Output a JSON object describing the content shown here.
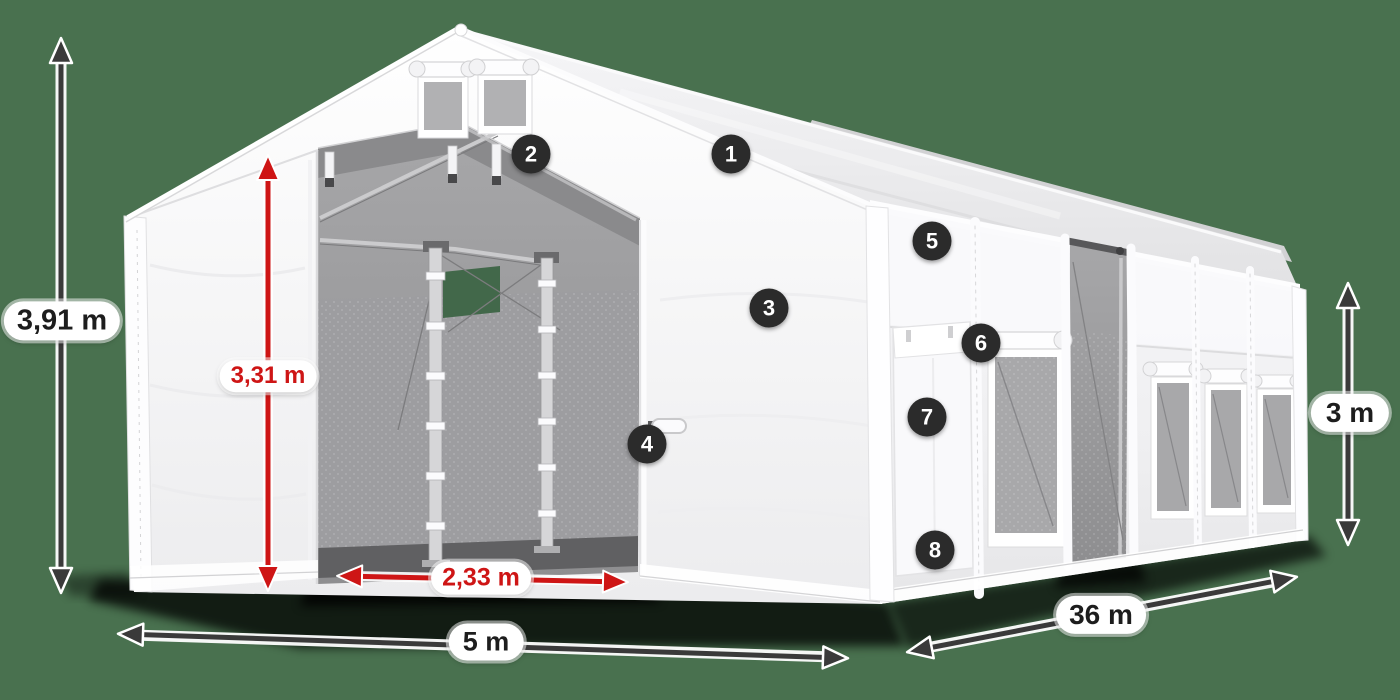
{
  "background_color": "#49714F",
  "colors": {
    "accent_red": "#CE1515",
    "arrow_dark": "#3A3A3A",
    "marker_background": "#2B2B2B",
    "marker_text": "#FFFFFF",
    "label_background": "#FFFFFF",
    "label_text": "#1D1D1D"
  },
  "dimensions": {
    "total_height": {
      "value": "3,91 m",
      "style": "dark"
    },
    "inner_door_height": {
      "value": "3,31 m",
      "style": "red"
    },
    "door_width": {
      "value": "2,33 m",
      "style": "red"
    },
    "front_width": {
      "value": "5 m",
      "style": "dark"
    },
    "length": {
      "value": "36 m",
      "style": "dark"
    },
    "side_height": {
      "value": "3 m",
      "style": "dark"
    }
  },
  "markers": [
    {
      "number": "1"
    },
    {
      "number": "2"
    },
    {
      "number": "3"
    },
    {
      "number": "4"
    },
    {
      "number": "5"
    },
    {
      "number": "6"
    },
    {
      "number": "7"
    },
    {
      "number": "8"
    }
  ]
}
